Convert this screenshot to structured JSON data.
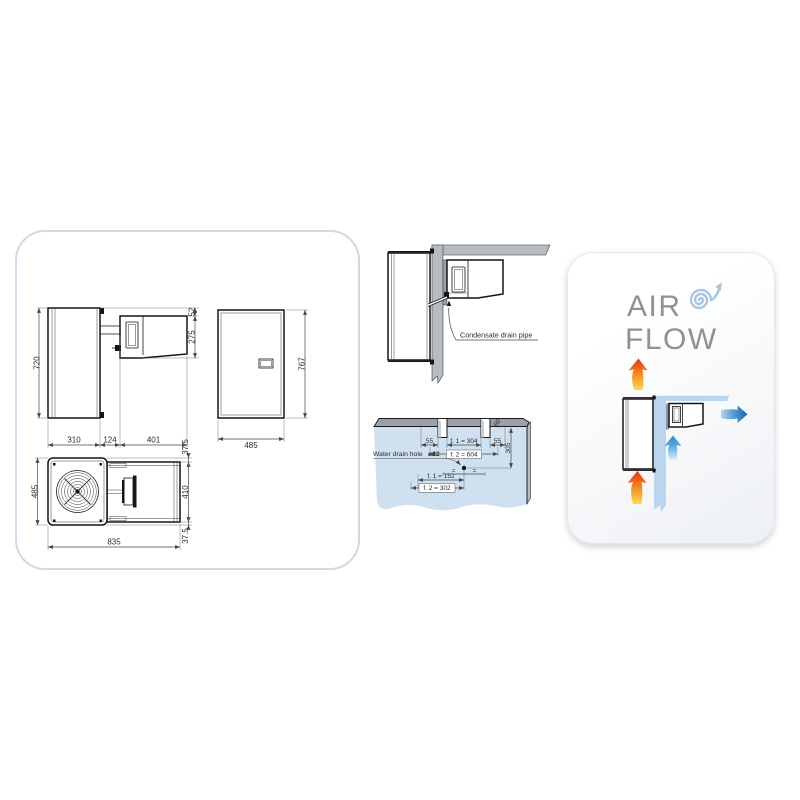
{
  "left_panel": {
    "side_view": {
      "height": "720",
      "w1": "310",
      "w2": "124",
      "w3": "401",
      "top_offset": "52",
      "unit_height": "275"
    },
    "front_view": {
      "width": "485",
      "height": "767"
    },
    "top_view": {
      "depth": "485",
      "width": "835",
      "inset_top": "37.5",
      "condenser_depth": "410",
      "inset_bottom": "37.5"
    }
  },
  "installation": {
    "condensate": {
      "label": "Condensate drain pipe"
    },
    "drain": {
      "left_offset": "55",
      "f1_slots": "f. 1 = 304",
      "right_offset": "55",
      "f2_slots": "f. 2 = 604",
      "depth_to_hole": "305",
      "wall_thickness": "60",
      "hole_label": "Water drain hole",
      "hole_diameter": "ø22",
      "f1_hole": "f. 1 = 152",
      "f2_hole": "f. 2 = 302",
      "equal_left": "=",
      "equal_right": "="
    }
  },
  "airflow": {
    "line1": "AIR",
    "line2": "FLOW"
  },
  "colors": {
    "panel_border": "#cfdae6",
    "wall_gray": "#b7bcc1",
    "wall_blue_plan": "#cfe1f0",
    "wall_blue_airflow": "#b9d6ee",
    "hot_air_yellow": "#ffd94f",
    "hot_air_red": "#e73212",
    "cold_air_blue": "#1665ad",
    "swirl_blue": "#a6c6e2",
    "title_gray": "#8f9194"
  }
}
